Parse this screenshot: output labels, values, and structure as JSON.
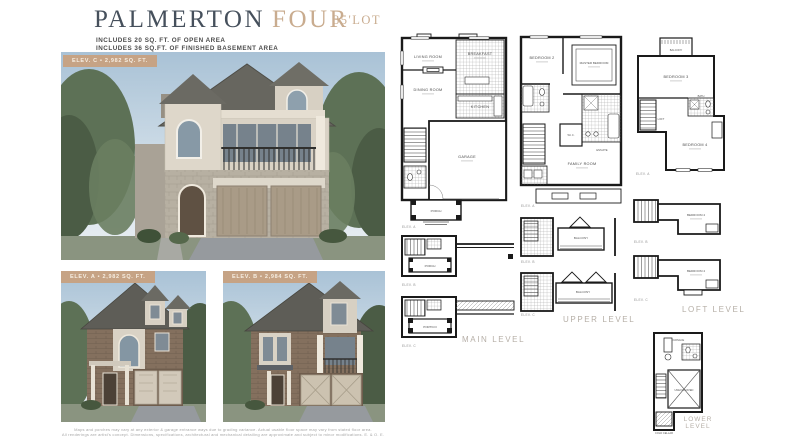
{
  "header": {
    "title_main": "PALMERTON",
    "title_accent": "FOUR",
    "lot": "35'LOT",
    "sub1": "INCLUDES 20 SQ. FT. OF OPEN AREA",
    "sub2": "INCLUDES 36 SQ.FT. OF FINISHED BASEMENT AREA"
  },
  "photos": {
    "main": {
      "band": "ELEV. C • 2,982 SQ. FT."
    },
    "elev_a": {
      "band": "ELEV. A • 2,982 SQ. FT."
    },
    "elev_b": {
      "band": "ELEV. B • 2,984 SQ. FT."
    }
  },
  "plans": {
    "main": {
      "level": "MAIN LEVEL",
      "rooms": {
        "living": "LIVING ROOM",
        "breakfast": "BREAKFAST",
        "dining": "DINING ROOM",
        "kitchen": "KITCHEN",
        "garage": "GARAGE",
        "porch": "PORCH",
        "portico": "PORTICO"
      },
      "variants": {
        "a": "ELEV. A",
        "b": "ELEV. B",
        "c": "ELEV. C"
      }
    },
    "upper": {
      "level": "UPPER LEVEL",
      "rooms": {
        "bedroom2": "BEDROOM 2",
        "master": "MASTER BEDROOM",
        "wic": "W.I.C.",
        "ensuite": "ENSUITE",
        "family": "FAMILY ROOM",
        "balcony": "BALCONY"
      },
      "variants": {
        "a": "ELEV. A",
        "b": "ELEV. B",
        "c": "ELEV. C"
      }
    },
    "loft": {
      "level": "LOFT LEVEL",
      "rooms": {
        "balcony": "BALCONY",
        "bedroom3": "BEDROOM 3",
        "bedroom4": "BEDROOM 4",
        "loft": "LOFT",
        "bath": "BATH"
      },
      "variants": {
        "a": "ELEV. A",
        "b": "ELEV. B",
        "c": "ELEV. C"
      }
    },
    "lower": {
      "level_line1": "LOWER",
      "level_line2": "LEVEL",
      "rooms": {
        "unexcavated": "UNEXCAVATED",
        "cold_cellar": "COLD CELLAR",
        "furnace": "FURNACE"
      }
    }
  },
  "disclaimer": {
    "line1": "Maps and porches may vary at any exterior & garage entrance ways due to grading variance. Actual usable floor space may vary from stated floor area.",
    "line2": "All renderings are artist's concept. Dimensions, specifications, architectural and mechanical detailing are approximate and subject to minor modifications. E. & O. E."
  },
  "colors": {
    "accent_tan": "#c9ac8f",
    "title_slate": "#46505c",
    "badge_tan": "#c6a385"
  }
}
